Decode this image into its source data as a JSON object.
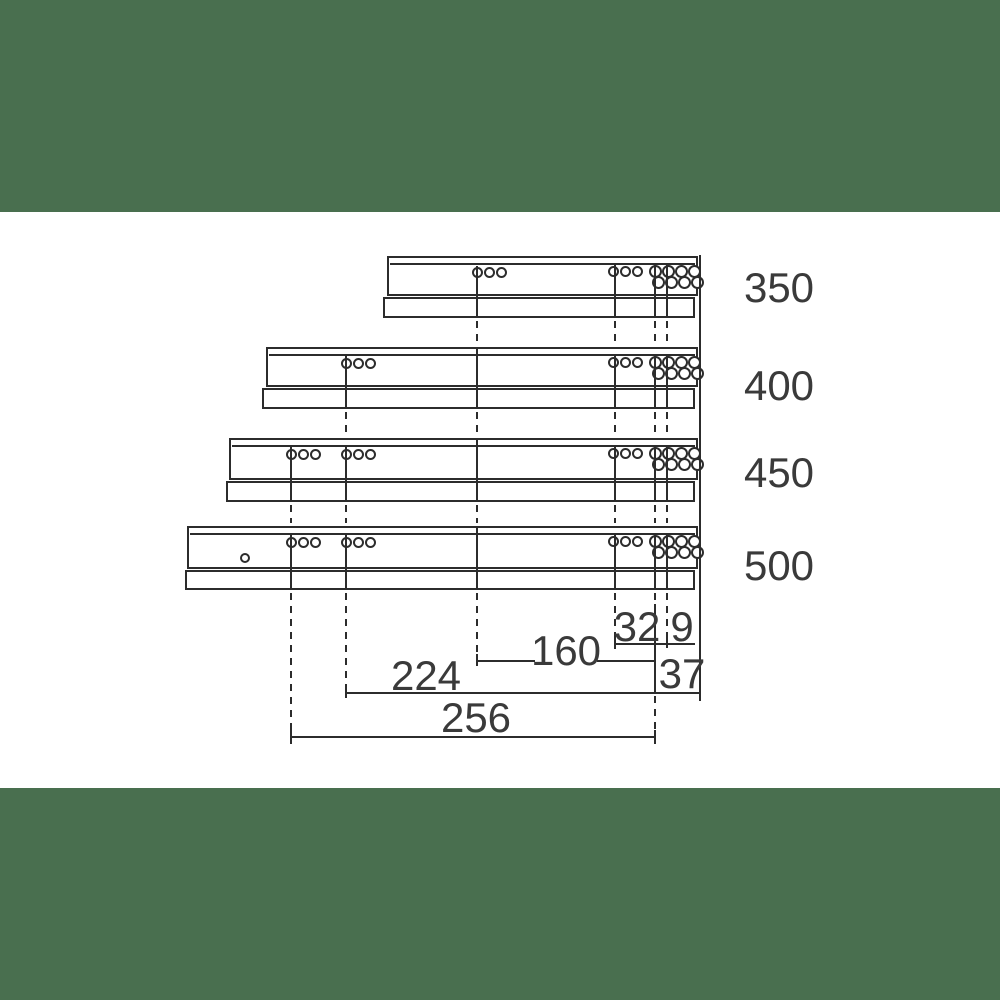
{
  "diagram": {
    "colors": {
      "line": "#2c2c2c",
      "text": "#3a3a3a",
      "band_green": "#496F4F",
      "background": "#ffffff"
    },
    "slide_lengths_mm": [
      "350",
      "400",
      "450",
      "500"
    ],
    "dimension_values_mm": [
      "32",
      "9",
      "160",
      "37",
      "224",
      "256"
    ],
    "labels": {
      "size_350": {
        "text": "350",
        "x": 779,
        "y": 288
      },
      "size_400": {
        "text": "400",
        "x": 779,
        "y": 386
      },
      "size_450": {
        "text": "450",
        "x": 779,
        "y": 473
      },
      "size_500": {
        "text": "500",
        "x": 779,
        "y": 566
      },
      "dim_32": {
        "text": "32",
        "x": 637,
        "y": 627
      },
      "dim_9": {
        "text": "9",
        "x": 682,
        "y": 627
      },
      "dim_160": {
        "text": "160",
        "x": 566,
        "y": 651
      },
      "dim_37": {
        "text": "37",
        "x": 682,
        "y": 674
      },
      "dim_224": {
        "text": "224",
        "x": 426,
        "y": 676
      },
      "dim_256": {
        "text": "256",
        "x": 476,
        "y": 718
      }
    },
    "slides": [
      {
        "size": "350",
        "body": [
          387,
          256,
          698,
          296
        ],
        "rail": [
          383,
          297,
          695,
          318
        ],
        "holes": [
          [
            477,
            272,
            5.5
          ],
          [
            489,
            272,
            5.5
          ],
          [
            501,
            272,
            5.5
          ],
          [
            613,
            271,
            5.5
          ],
          [
            625,
            271,
            5.5
          ],
          [
            637,
            271,
            5.5
          ],
          [
            655,
            271,
            6.5
          ],
          [
            668,
            271,
            6.5
          ],
          [
            681,
            271,
            6.5
          ],
          [
            694,
            271,
            6.5
          ],
          [
            658,
            282,
            6.5
          ],
          [
            671,
            282,
            6.5
          ],
          [
            684,
            282,
            6.5
          ],
          [
            697,
            282,
            6.5
          ]
        ]
      },
      {
        "size": "400",
        "body": [
          266,
          347,
          698,
          387
        ],
        "rail": [
          262,
          388,
          695,
          409
        ],
        "holes": [
          [
            346,
            363,
            5.5
          ],
          [
            358,
            363,
            5.5
          ],
          [
            370,
            363,
            5.5
          ],
          [
            613,
            362,
            5.5
          ],
          [
            625,
            362,
            5.5
          ],
          [
            637,
            362,
            5.5
          ],
          [
            655,
            362,
            6.5
          ],
          [
            668,
            362,
            6.5
          ],
          [
            681,
            362,
            6.5
          ],
          [
            694,
            362,
            6.5
          ],
          [
            658,
            373,
            6.5
          ],
          [
            671,
            373,
            6.5
          ],
          [
            684,
            373,
            6.5
          ],
          [
            697,
            373,
            6.5
          ]
        ]
      },
      {
        "size": "450",
        "body": [
          229,
          438,
          698,
          480
        ],
        "rail": [
          226,
          481,
          695,
          502
        ],
        "holes": [
          [
            291,
            454,
            5.5
          ],
          [
            303,
            454,
            5.5
          ],
          [
            315,
            454,
            5.5
          ],
          [
            346,
            454,
            5.5
          ],
          [
            358,
            454,
            5.5
          ],
          [
            370,
            454,
            5.5
          ],
          [
            613,
            453,
            5.5
          ],
          [
            625,
            453,
            5.5
          ],
          [
            637,
            453,
            5.5
          ],
          [
            655,
            453,
            6.5
          ],
          [
            668,
            453,
            6.5
          ],
          [
            681,
            453,
            6.5
          ],
          [
            694,
            453,
            6.5
          ],
          [
            658,
            464,
            6.5
          ],
          [
            671,
            464,
            6.5
          ],
          [
            684,
            464,
            6.5
          ],
          [
            697,
            464,
            6.5
          ]
        ]
      },
      {
        "size": "500",
        "body": [
          187,
          526,
          698,
          569
        ],
        "rail": [
          185,
          570,
          695,
          590
        ],
        "holes": [
          [
            245,
            558,
            5
          ],
          [
            291,
            542,
            5.5
          ],
          [
            303,
            542,
            5.5
          ],
          [
            315,
            542,
            5.5
          ],
          [
            346,
            542,
            5.5
          ],
          [
            358,
            542,
            5.5
          ],
          [
            370,
            542,
            5.5
          ],
          [
            613,
            541,
            5.5
          ],
          [
            625,
            541,
            5.5
          ],
          [
            637,
            541,
            5.5
          ],
          [
            655,
            541,
            6.5
          ],
          [
            668,
            541,
            6.5
          ],
          [
            681,
            541,
            6.5
          ],
          [
            694,
            541,
            6.5
          ],
          [
            658,
            552,
            6.5
          ],
          [
            671,
            552,
            6.5
          ],
          [
            684,
            552,
            6.5
          ],
          [
            697,
            552,
            6.5
          ]
        ]
      }
    ],
    "vlines": [
      {
        "x": 291,
        "segs": [
          [
            447,
            502,
            "s"
          ],
          [
            505,
            523,
            "d"
          ],
          [
            535,
            590,
            "s"
          ],
          [
            593,
            730,
            "d"
          ],
          [
            730,
            744,
            "s"
          ]
        ]
      },
      {
        "x": 346,
        "segs": [
          [
            356,
            409,
            "s"
          ],
          [
            412,
            435,
            "d"
          ],
          [
            447,
            502,
            "s"
          ],
          [
            505,
            523,
            "d"
          ],
          [
            535,
            590,
            "s"
          ],
          [
            593,
            686,
            "d"
          ],
          [
            686,
            698,
            "s"
          ]
        ]
      },
      {
        "x": 477,
        "segs": [
          [
            266,
            318,
            "s"
          ],
          [
            321,
            344,
            "d"
          ],
          [
            347,
            409,
            "s"
          ],
          [
            412,
            435,
            "d"
          ],
          [
            438,
            502,
            "s"
          ],
          [
            505,
            523,
            "d"
          ],
          [
            526,
            590,
            "s"
          ],
          [
            593,
            654,
            "d"
          ],
          [
            654,
            666,
            "s"
          ]
        ]
      },
      {
        "x": 615,
        "segs": [
          [
            265,
            318,
            "s"
          ],
          [
            321,
            344,
            "d"
          ],
          [
            356,
            409,
            "s"
          ],
          [
            412,
            435,
            "d"
          ],
          [
            447,
            502,
            "s"
          ],
          [
            505,
            523,
            "d"
          ],
          [
            535,
            590,
            "s"
          ],
          [
            593,
            637,
            "d"
          ],
          [
            637,
            649,
            "s"
          ]
        ]
      },
      {
        "x": 655,
        "segs": [
          [
            264,
            318,
            "s"
          ],
          [
            321,
            344,
            "d"
          ],
          [
            355,
            409,
            "s"
          ],
          [
            412,
            435,
            "d"
          ],
          [
            446,
            502,
            "s"
          ],
          [
            505,
            523,
            "d"
          ],
          [
            534,
            590,
            "s"
          ],
          [
            593,
            604,
            "d"
          ],
          [
            604,
            694,
            "s"
          ],
          [
            696,
            730,
            "d"
          ],
          [
            730,
            744,
            "s"
          ]
        ]
      },
      {
        "x": 667,
        "segs": [
          [
            264,
            318,
            "s"
          ],
          [
            321,
            344,
            "d"
          ],
          [
            355,
            409,
            "s"
          ],
          [
            412,
            435,
            "d"
          ],
          [
            446,
            502,
            "s"
          ],
          [
            505,
            523,
            "d"
          ],
          [
            534,
            590,
            "s"
          ],
          [
            593,
            638,
            "d"
          ],
          [
            638,
            648,
            "s"
          ]
        ]
      }
    ],
    "hlines": [
      {
        "label": "dim-line-32-9",
        "y": 643,
        "x1": 616,
        "x2": 695
      },
      {
        "label": "dim-line-160-a",
        "y": 660,
        "x1": 477,
        "x2": 535
      },
      {
        "label": "dim-line-160-b",
        "y": 660,
        "x1": 597,
        "x2": 655
      },
      {
        "label": "dim-line-224-37",
        "y": 692,
        "x1": 346,
        "x2": 700
      },
      {
        "label": "dim-line-256",
        "y": 736,
        "x1": 291,
        "x2": 655
      }
    ],
    "border": {
      "x": 700,
      "y1": 255,
      "y2": 701
    }
  }
}
